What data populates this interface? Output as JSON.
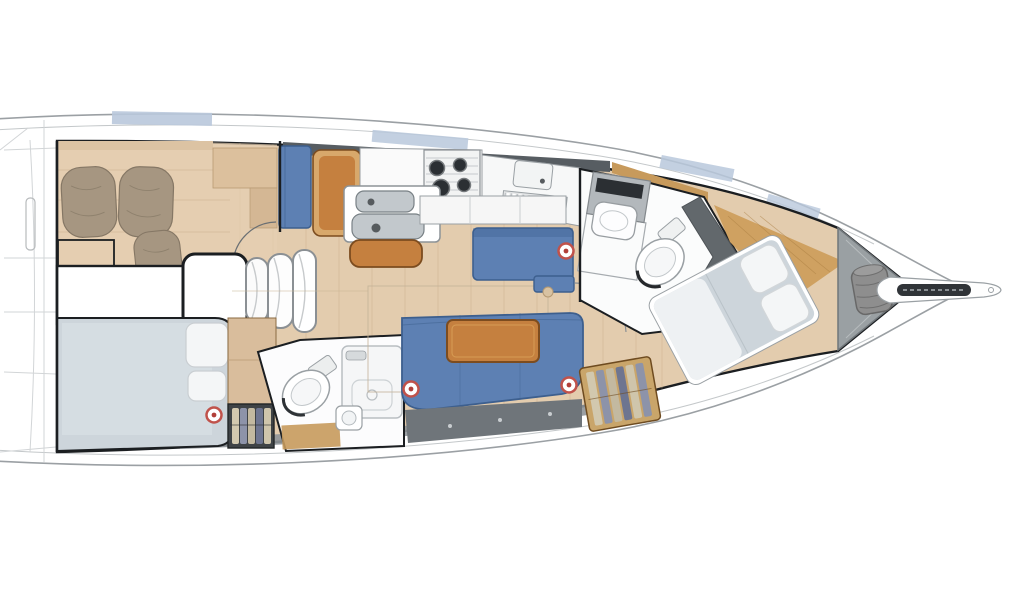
{
  "plan": {
    "type": "sailing-yacht-interior-deck-plan-top-view",
    "orientation": "bow-right"
  },
  "regions": [
    {
      "id": "hull",
      "label": "hull outline"
    },
    {
      "id": "aft-cabin-starboard",
      "label": "aft double cabin (upper)"
    },
    {
      "id": "companionway",
      "label": "companionway steps and engine box"
    },
    {
      "id": "aft-cabin-port",
      "label": "aft double cabin (lower)"
    },
    {
      "id": "aft-head",
      "label": "aft head with shower"
    },
    {
      "id": "galley",
      "label": "L-shaped galley"
    },
    {
      "id": "nav-station",
      "label": "chart table with seat"
    },
    {
      "id": "salon",
      "label": "salon with settees and table"
    },
    {
      "id": "forward-head",
      "label": "forward head with shower bench"
    },
    {
      "id": "forward-cabin",
      "label": "forward cabin island berth"
    },
    {
      "id": "anchor-locker",
      "label": "anchor locker"
    },
    {
      "id": "bowsprit",
      "label": "bowsprit with anchor roller"
    }
  ],
  "markers": [
    {
      "name": "deck-fitting",
      "transform": "translate(214,415)"
    },
    {
      "name": "deck-fitting",
      "transform": "translate(566,251)"
    },
    {
      "name": "deck-fitting",
      "transform": "translate(411,389)"
    },
    {
      "name": "deck-fitting",
      "transform": "translate(569,385)"
    }
  ],
  "colors": {
    "hull_line": "#9ba0a4",
    "toe_rail": "#c4c8ca",
    "outline": "#1b1e21",
    "floor_wood": "#e3ccae",
    "floor_wood_deep": "#e6cfb2",
    "plank": "#c9ae8c",
    "trim_wood": "#c79a5c",
    "furniture_wood": "#c5803f",
    "furniture_wood_dark": "#7c4c1f",
    "furniture_wood_light": "#daa258",
    "upholstery": "#5d80b3",
    "upholstery_dark": "#3d5f8e",
    "berth_grey": "#cdd5db",
    "linen": "#f4f6f7",
    "pillow_taupe": "#a69681",
    "pillow_line": "#857765",
    "window_blue": "#b9c8dc",
    "window_band": "#575d62",
    "fixture": "#fbfcfc",
    "fixture_line": "#9aa0a4",
    "steel": "#c2c8cc",
    "steel_dark": "#788085",
    "appliance_dark": "#2b2f33",
    "locker_grey": "#6f757a",
    "hull_shade": "#8f9599",
    "anchor_locker": "#9aa0a3",
    "gear_bag": "#8e8e8e",
    "marker_ring": "#c0524b",
    "marker_red": "#b23f39",
    "wardrobe_dark": "#3f4346",
    "wardrobe_wood": "#c9a56a",
    "clothes_a": "#d2c8ae",
    "clothes_b": "#8d93a9",
    "clothes_c": "#c3b9a0",
    "clothes_d": "#6e7590",
    "clothes_e": "#cfc5ab"
  }
}
